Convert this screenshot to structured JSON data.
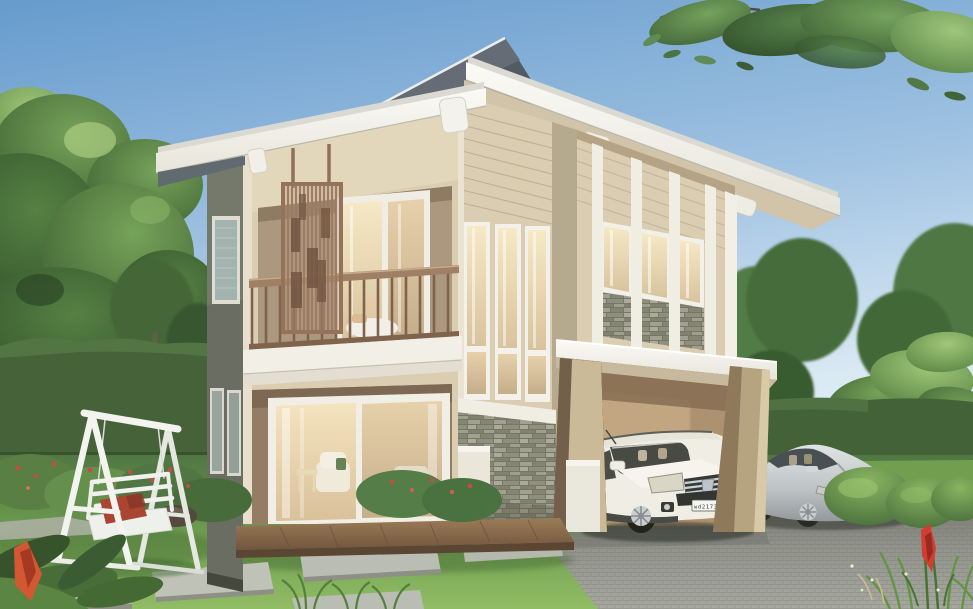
{
  "scene": {
    "title": "Two-storey modern tropical house exterior rendering",
    "setting": "garden with lawn, hedges, trees, stepping-stone path and paver driveway"
  },
  "vehicles": {
    "suv_label": "white SUV under carport",
    "suv_plate": "wd21739",
    "sedan_label": "silver sedan on driveway",
    "sedan_plate": "wd21739"
  },
  "house": {
    "style": "modern tropical two-storey",
    "features_left_block": "balcony with timber slat screen and wood railing, sliding glass doors",
    "features_tower": "clerestory bay with three tall windows over stacked-stone base",
    "features_right_wing": "three windows with stone spandrels, white battens, carport below"
  },
  "garden": {
    "swing_label": "white A-frame garden swing with red cushion",
    "flower_accent": "red ginger flower"
  },
  "palette": {
    "sky_top": "#5f96cb",
    "sky_horizon": "#eaf2f9",
    "roof_white": "#f6f5f0",
    "gable_shadow": "#49525c",
    "wall_cream": "#d8cbAF",
    "wall_side_dark": "#63665a",
    "wood_brown": "#8a684f",
    "stone_gray": "#8a8b79",
    "glass_warm": "#eedcb6",
    "grass_green": "#5f9040",
    "hedge_green": "#3c5a2f",
    "driveway_gray": "#90928a",
    "swing_white": "#f3f4f1",
    "cushion_red": "#a53b28",
    "suv_white": "#efece4",
    "sedan_silver": "#c3c8ca",
    "flower_red": "#cf3326"
  }
}
